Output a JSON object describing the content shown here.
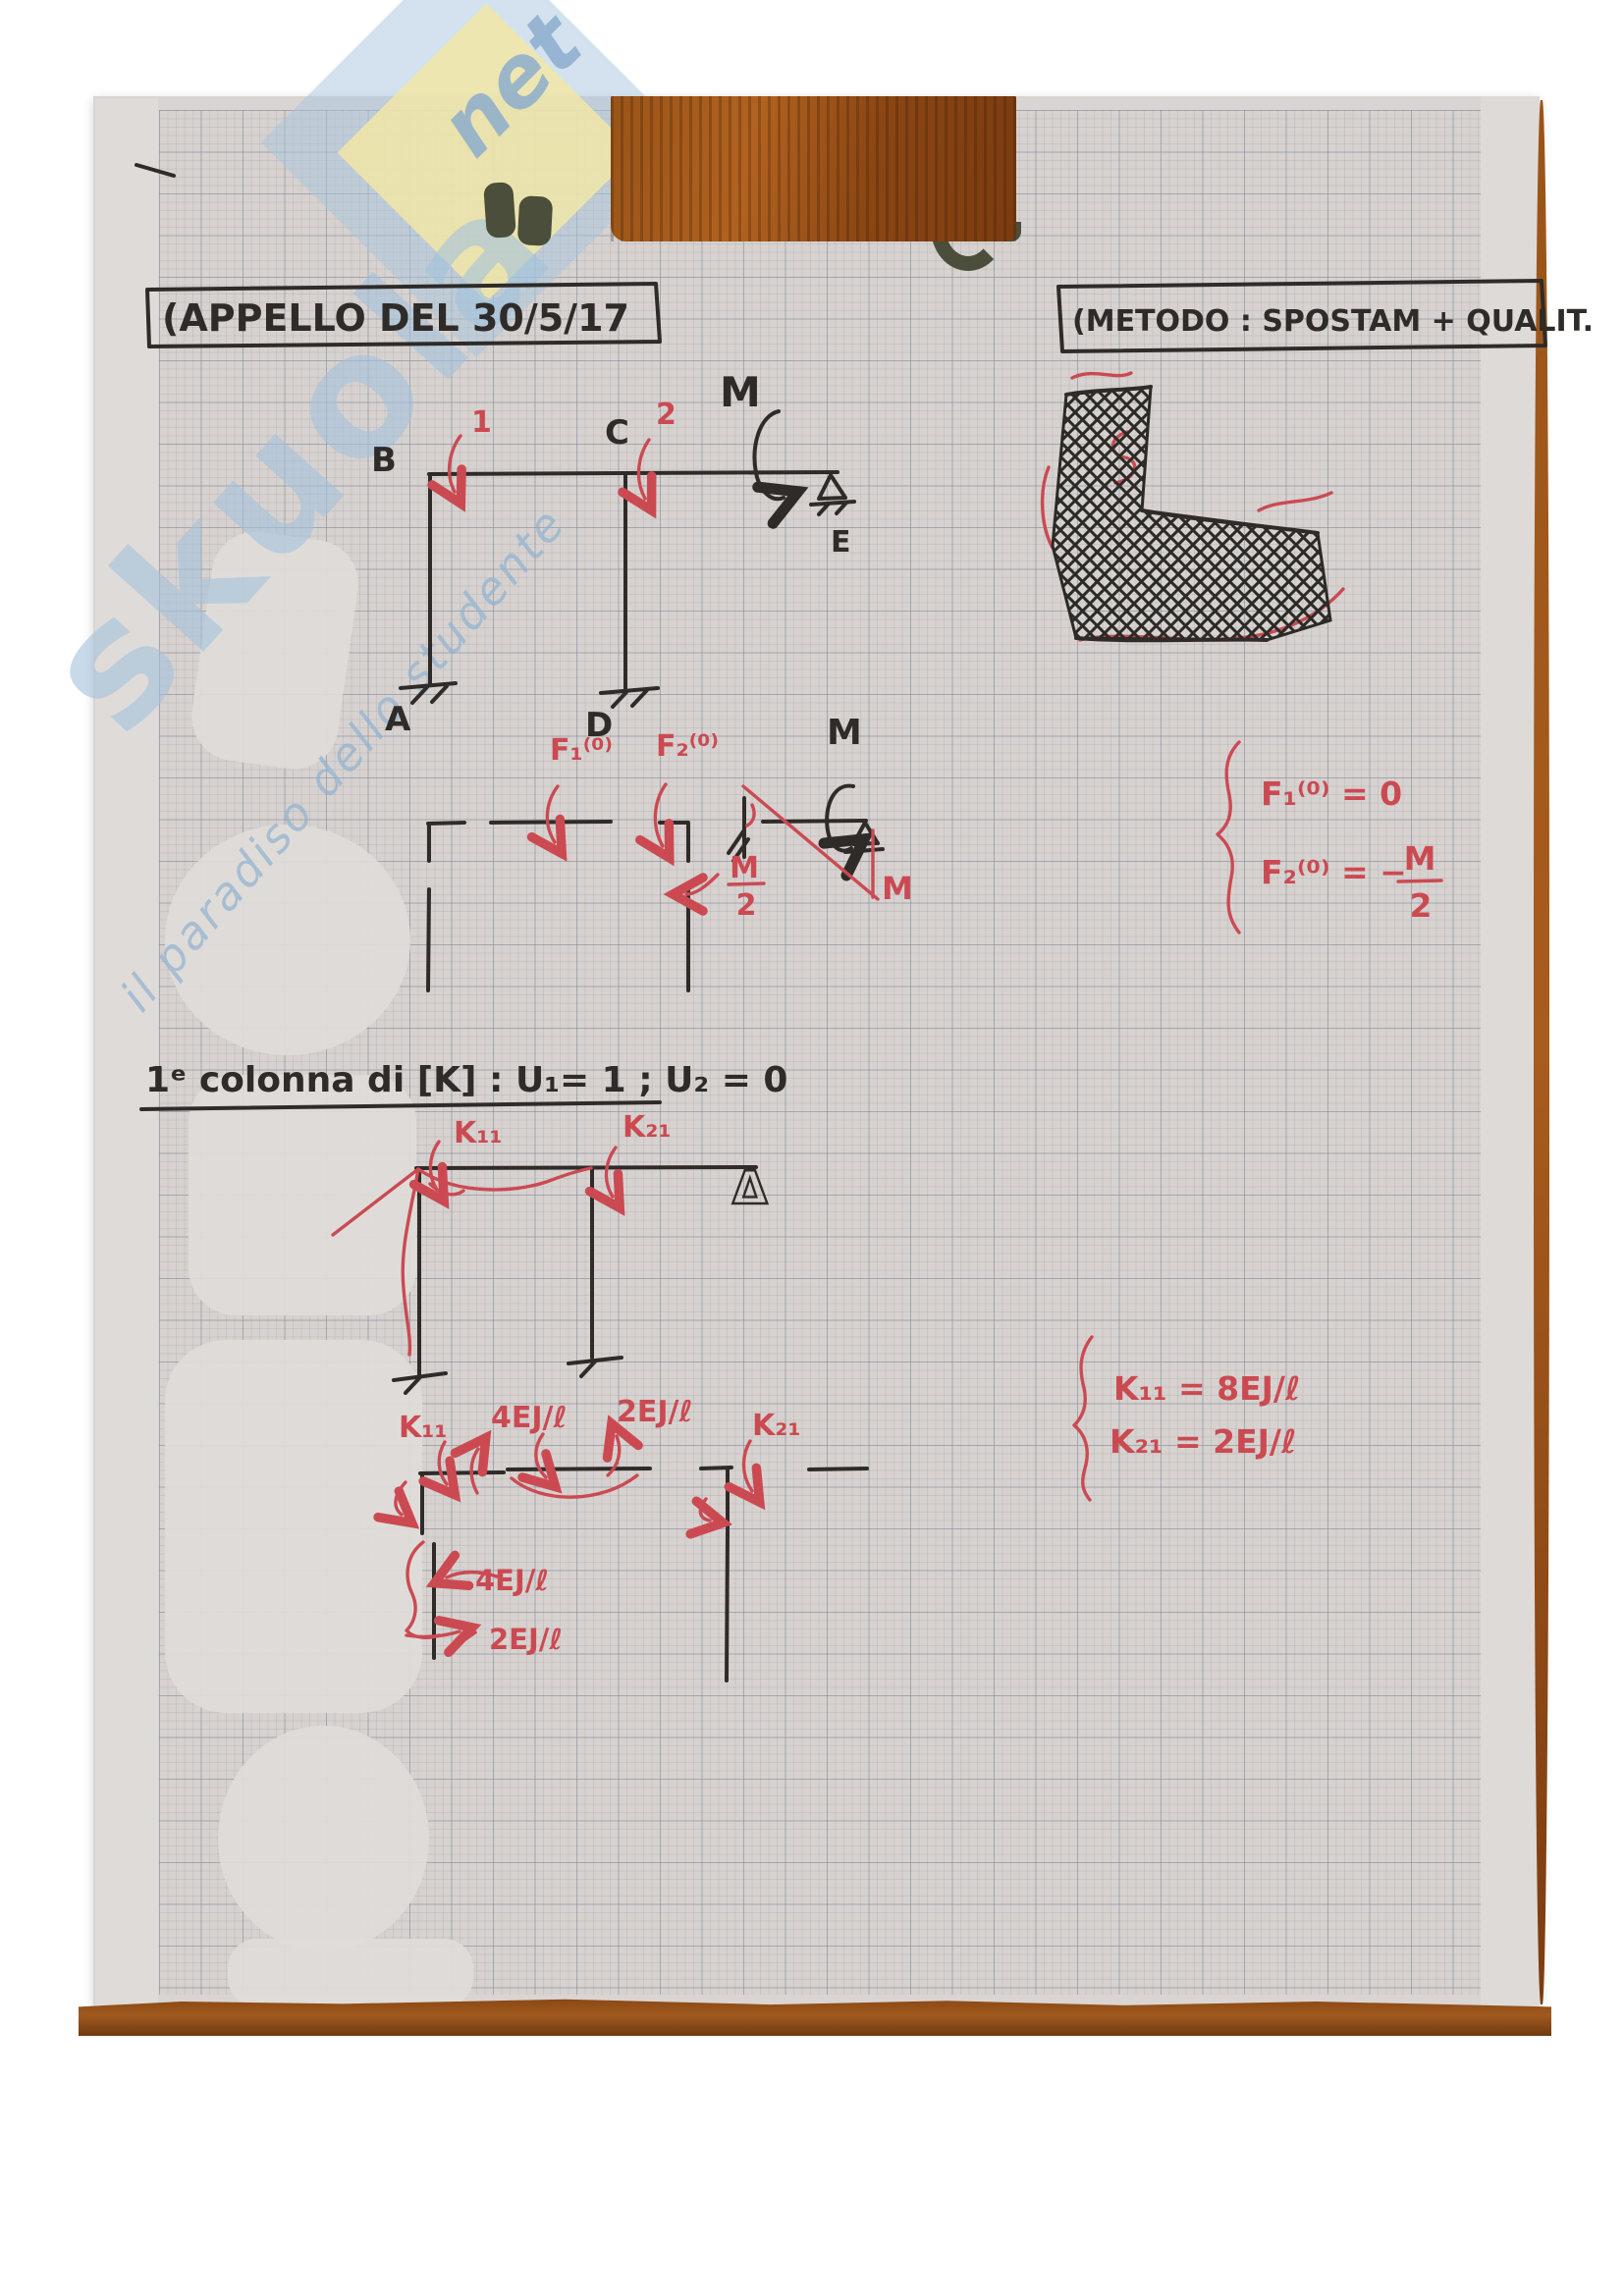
{
  "header": {
    "left_box": "(APPELLO DEL 30/5/17",
    "right_box": "(METODO : SPOSTAM + QUALIT."
  },
  "watermark": {
    "brand": "skuola",
    "net": "net",
    "tagline": "il paradiso dello studente"
  },
  "frame": {
    "labels": {
      "b": "B",
      "c": "C",
      "a": "A",
      "d": "D",
      "e": "E"
    },
    "moment": "M",
    "dof1": "1",
    "dof2": "2"
  },
  "released": {
    "f1": "F₁⁽⁰⁾",
    "f2": "F₂⁽⁰⁾",
    "m_top": "M",
    "frac_num": "M",
    "frac_den": "2",
    "m_diag": "M"
  },
  "f_eqs": {
    "line1": "F₁⁽⁰⁾ = 0",
    "line2_lhs": "F₂⁽⁰⁾ = −",
    "line2_num": "M",
    "line2_den": "2"
  },
  "section": {
    "title": "1ᵉ colonna di [K] :  U₁= 1  ;  U₂ = 0"
  },
  "kframe": {
    "k11": "K₁₁",
    "k21": "K₂₁",
    "delta": "Δ"
  },
  "k_eqs": {
    "line1": "K₁₁ = 8EJ/ℓ",
    "line2": "K₂₁ = 2EJ/ℓ"
  },
  "members": {
    "k11": "K₁₁",
    "m4": "4EJ/ℓ",
    "m2": "2EJ/ℓ",
    "k21": "K₂₁",
    "col4": "4EJ/ℓ",
    "col2": "2EJ/ℓ"
  },
  "colors": {
    "ink_black": "#2e2b28",
    "ink_red": "#cb4a52",
    "paper": "#d7d2cf",
    "wood": "#a05a1e",
    "watermark_blue": "#a9c6dd",
    "watermark_yellow": "#f0e6a8"
  }
}
